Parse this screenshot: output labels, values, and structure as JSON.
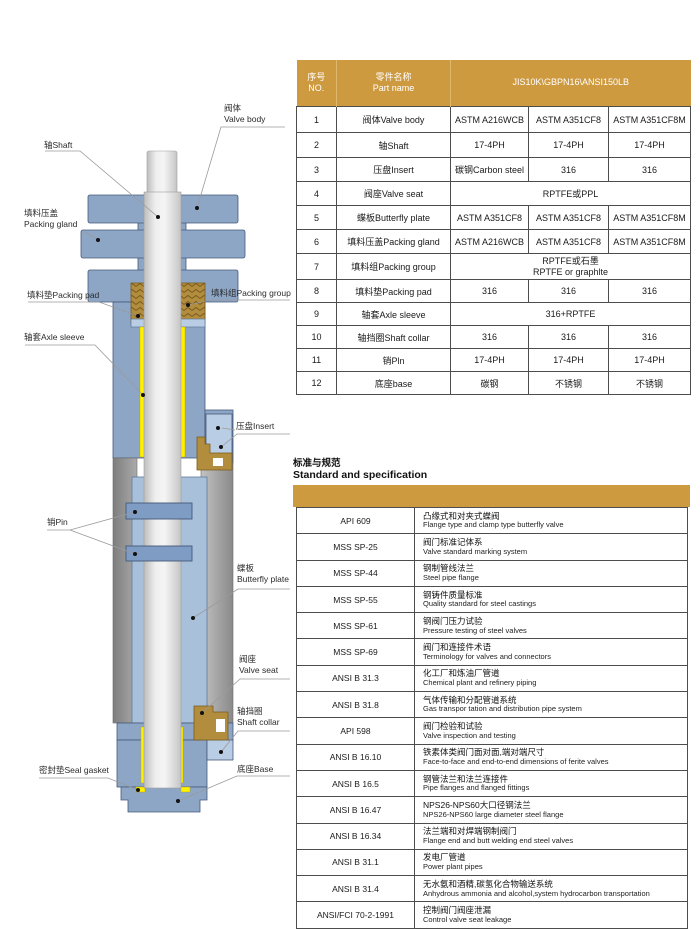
{
  "colors": {
    "gold_header": "#CE9A40",
    "body_blue": "#8DA6C6",
    "hub_blue": "#A9C0DB",
    "pocket_blue": "#B9CDE4",
    "pin_blue": "#7E9CC4",
    "packing_gold": "#B28D3E",
    "sleeve_yellow": "#FFF100",
    "border_dark": "#4d4d4d"
  },
  "diagram": {
    "labels": {
      "valve_body": {
        "zh": "阀体",
        "en": "Valve body"
      },
      "shaft": {
        "text": "轴Shaft"
      },
      "packing_gland": {
        "zh": "填料压盖",
        "en": "Packing gland"
      },
      "packing_pad": {
        "text": "填料垫Packing pad"
      },
      "packing_group": {
        "text": "填料组Packing group"
      },
      "axle_sleeve": {
        "text": "轴套Axle sleeve"
      },
      "insert": {
        "text": "压盘Insert"
      },
      "pin": {
        "text": "销Pin"
      },
      "butterfly_plate": {
        "zh": "蝶板",
        "en": "Butterfly plate"
      },
      "valve_seat": {
        "zh": "阀座",
        "en": "Valve seat"
      },
      "shaft_collar": {
        "zh": "轴挡圈",
        "en": "Shaft collar"
      },
      "seal_gasket": {
        "text": "密封垫Seal gasket"
      },
      "base": {
        "text": "底座Base"
      }
    }
  },
  "parts_table": {
    "header": {
      "no_zh": "序号",
      "no_en": "NO.",
      "name_zh": "零件名称",
      "name_en": "Part name",
      "materials": "JIS10K\\GBPN16\\ANSI150LB"
    },
    "rows": [
      {
        "no": "1",
        "name": "阀体Valve body",
        "m1": "ASTM A216WCB",
        "m2": "ASTM A351CF8",
        "m3": "ASTM A351CF8M"
      },
      {
        "no": "2",
        "name": "轴Shaft",
        "m1": "17-4PH",
        "m2": "17-4PH",
        "m3": "17-4PH"
      },
      {
        "no": "3",
        "name": "压盘Insert",
        "m1": "碳钢Carbon steel",
        "m2": "316",
        "m3": "316"
      },
      {
        "no": "4",
        "name": "阀座Valve seat",
        "span": "RPTFE或PPL"
      },
      {
        "no": "5",
        "name": "蝶板Butterfly plate",
        "m1": "ASTM A351CF8",
        "m2": "ASTM A351CF8",
        "m3": "ASTM A351CF8M"
      },
      {
        "no": "6",
        "name": "填料压盖Packing gland",
        "m1": "ASTM A216WCB",
        "m2": "ASTM A351CF8",
        "m3": "ASTM A351CF8M"
      },
      {
        "no": "7",
        "name": "填料组Packing group",
        "span_line1": "RPTFE或石墨",
        "span_line2": "RPTFE or graphlte"
      },
      {
        "no": "8",
        "name": "填料垫Packing pad",
        "m1": "316",
        "m2": "316",
        "m3": "316"
      },
      {
        "no": "9",
        "name": "轴套Axle sleeve",
        "span": "316+RPTFE"
      },
      {
        "no": "10",
        "name": "轴挡圈Shaft collar",
        "m1": "316",
        "m2": "316",
        "m3": "316"
      },
      {
        "no": "11",
        "name": "销Pln",
        "m1": "17-4PH",
        "m2": "17-4PH",
        "m3": "17-4PH"
      },
      {
        "no": "12",
        "name": "底座base",
        "m1": "碳钢",
        "m2": "不锈钢",
        "m3": "不锈钢"
      }
    ]
  },
  "standards": {
    "title_zh": "标准与规范",
    "title_en": "Standard and specification",
    "rows": [
      {
        "code": "API 609",
        "zh": "凸缘式和对夹式蝶阀",
        "en": "Flange type and clamp type butterfly valve"
      },
      {
        "code": "MSS SP-25",
        "zh": "阀门标准记体系",
        "en": "Valve standard marking system"
      },
      {
        "code": "MSS SP-44",
        "zh": "钢制管线法兰",
        "en": "Steel pipe flange"
      },
      {
        "code": "MSS SP-55",
        "zh": "钢铸件质量标准",
        "en": "Quality standard for steel castings"
      },
      {
        "code": "MSS SP-61",
        "zh": "钢阀门压力试验",
        "en": "Pressure testing of steel valves"
      },
      {
        "code": "MSS SP-69",
        "zh": "阀门和连接件术语",
        "en": "Terminology for valves and connectors"
      },
      {
        "code": "ANSI B 31.3",
        "zh": "化工厂和炼油厂管道",
        "en": "Chemical plant and refinery piping"
      },
      {
        "code": "ANSI B 31.8",
        "zh": "气体传输和分配管道系统",
        "en": "Gas transpor tation and distribution pipe system"
      },
      {
        "code": "API 598",
        "zh": "阀门检验和试验",
        "en": "Valve inspection and testing"
      },
      {
        "code": "ANSI B 16.10",
        "zh": "铁素体类阀门面对面,端对端尺寸",
        "en": "Face-to-face and end-to-end dimensions of ferite valves"
      },
      {
        "code": "ANSI B 16.5",
        "zh": "钢管法兰和法兰连接件",
        "en": "Pipe flanges and flanged fittings"
      },
      {
        "code": "ANSI B 16.47",
        "zh": "NPS26-NPS60大口径钢法兰",
        "en": "NPS26-NPS60 large diameter steel flange"
      },
      {
        "code": "ANSI B 16.34",
        "zh": "法兰端和对焊端钢制阀门",
        "en": "Flange end and butt welding end steel valves"
      },
      {
        "code": "ANSI B 31.1",
        "zh": "发电厂管道",
        "en": "Power plant pipes"
      },
      {
        "code": "ANSI B 31.4",
        "zh": "无水氨和酒精,碳氢化合物输送系统",
        "en": "Anhydrous ammonia and alcohol,system hydrocarbon transportation"
      },
      {
        "code": "ANSI/FCI 70-2-1991",
        "zh": "控制阀门阀座泄漏",
        "en": "Control valve seat leakage"
      }
    ]
  }
}
